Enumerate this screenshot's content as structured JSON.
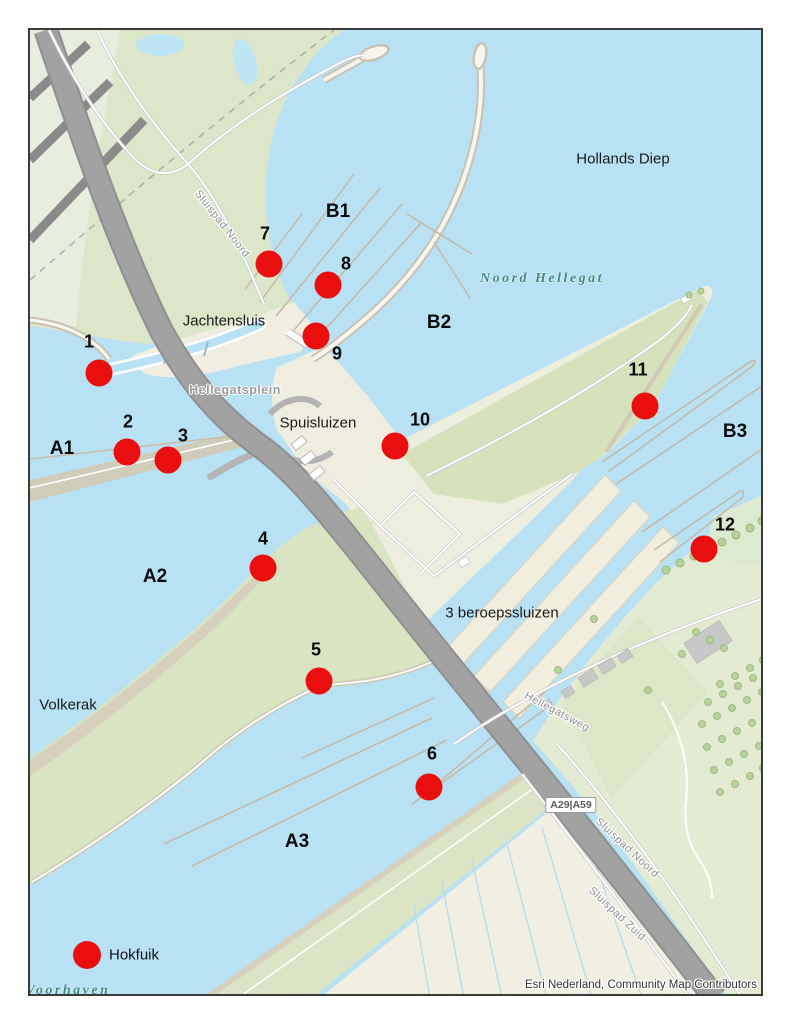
{
  "map": {
    "attribution": "Esri Nederland, Community Map Contributors",
    "colors": {
      "marker": "#e90f0f",
      "water": "#b9e1f4",
      "land_green": "#d8e4c2",
      "land_cream": "#f0eee1",
      "road_gray": "#a2a2a2"
    },
    "legend": {
      "symbol": "red-dot",
      "label": "Hokfuik",
      "x": 85,
      "y": 953
    },
    "stations": [
      {
        "id": "1",
        "x": 97,
        "y": 371,
        "lx": 87,
        "ly": 340
      },
      {
        "id": "2",
        "x": 125,
        "y": 450,
        "lx": 126,
        "ly": 420
      },
      {
        "id": "3",
        "x": 166,
        "y": 458,
        "lx": 181,
        "ly": 434
      },
      {
        "id": "4",
        "x": 261,
        "y": 566,
        "lx": 261,
        "ly": 537
      },
      {
        "id": "5",
        "x": 317,
        "y": 679,
        "lx": 314,
        "ly": 648
      },
      {
        "id": "6",
        "x": 427,
        "y": 785,
        "lx": 430,
        "ly": 752
      },
      {
        "id": "7",
        "x": 267,
        "y": 262,
        "lx": 263,
        "ly": 232
      },
      {
        "id": "8",
        "x": 326,
        "y": 283,
        "lx": 344,
        "ly": 262
      },
      {
        "id": "9",
        "x": 314,
        "y": 334,
        "lx": 335,
        "ly": 352
      },
      {
        "id": "10",
        "x": 393,
        "y": 444,
        "lx": 418,
        "ly": 418
      },
      {
        "id": "11",
        "x": 643,
        "y": 404,
        "lx": 636,
        "ly": 368
      },
      {
        "id": "12",
        "x": 702,
        "y": 547,
        "lx": 723,
        "ly": 523
      }
    ],
    "zone_labels": [
      {
        "text": "A1",
        "x": 60,
        "y": 447
      },
      {
        "text": "A2",
        "x": 153,
        "y": 575
      },
      {
        "text": "A3",
        "x": 295,
        "y": 840
      },
      {
        "text": "B1",
        "x": 336,
        "y": 210
      },
      {
        "text": "B2",
        "x": 437,
        "y": 321
      },
      {
        "text": "B3",
        "x": 733,
        "y": 430
      }
    ],
    "place_labels": [
      {
        "text": "Hollands Diep",
        "x": 621,
        "y": 157,
        "muted": false
      },
      {
        "text": "Jachtensluis",
        "x": 222,
        "y": 319,
        "muted": false
      },
      {
        "text": "Spuisluizen",
        "x": 316,
        "y": 421,
        "muted": false
      },
      {
        "text": "3 beroepssluizen",
        "x": 500,
        "y": 611,
        "muted": false
      },
      {
        "text": "Volkerak",
        "x": 66,
        "y": 703,
        "muted": false
      },
      {
        "text": "Hellegatsplein",
        "x": 233,
        "y": 388,
        "muted": true
      }
    ],
    "water_labels": [
      {
        "text": "Noord Hellegat",
        "x": 540,
        "y": 277
      },
      {
        "text": "Voorhaven",
        "x": 66,
        "y": 989
      }
    ],
    "road_labels": [
      {
        "text": "Sluispad Noord",
        "x": 220,
        "y": 222,
        "rot": 52
      },
      {
        "text": "Hellegatsweg",
        "x": 555,
        "y": 710,
        "rot": 28
      },
      {
        "text": "Sluispad Noord",
        "x": 625,
        "y": 846,
        "rot": 43
      },
      {
        "text": "Sluispad Zuid",
        "x": 615,
        "y": 912,
        "rot": 43
      }
    ],
    "road_shield": {
      "text": "A29|A59",
      "x": 569,
      "y": 803
    }
  }
}
